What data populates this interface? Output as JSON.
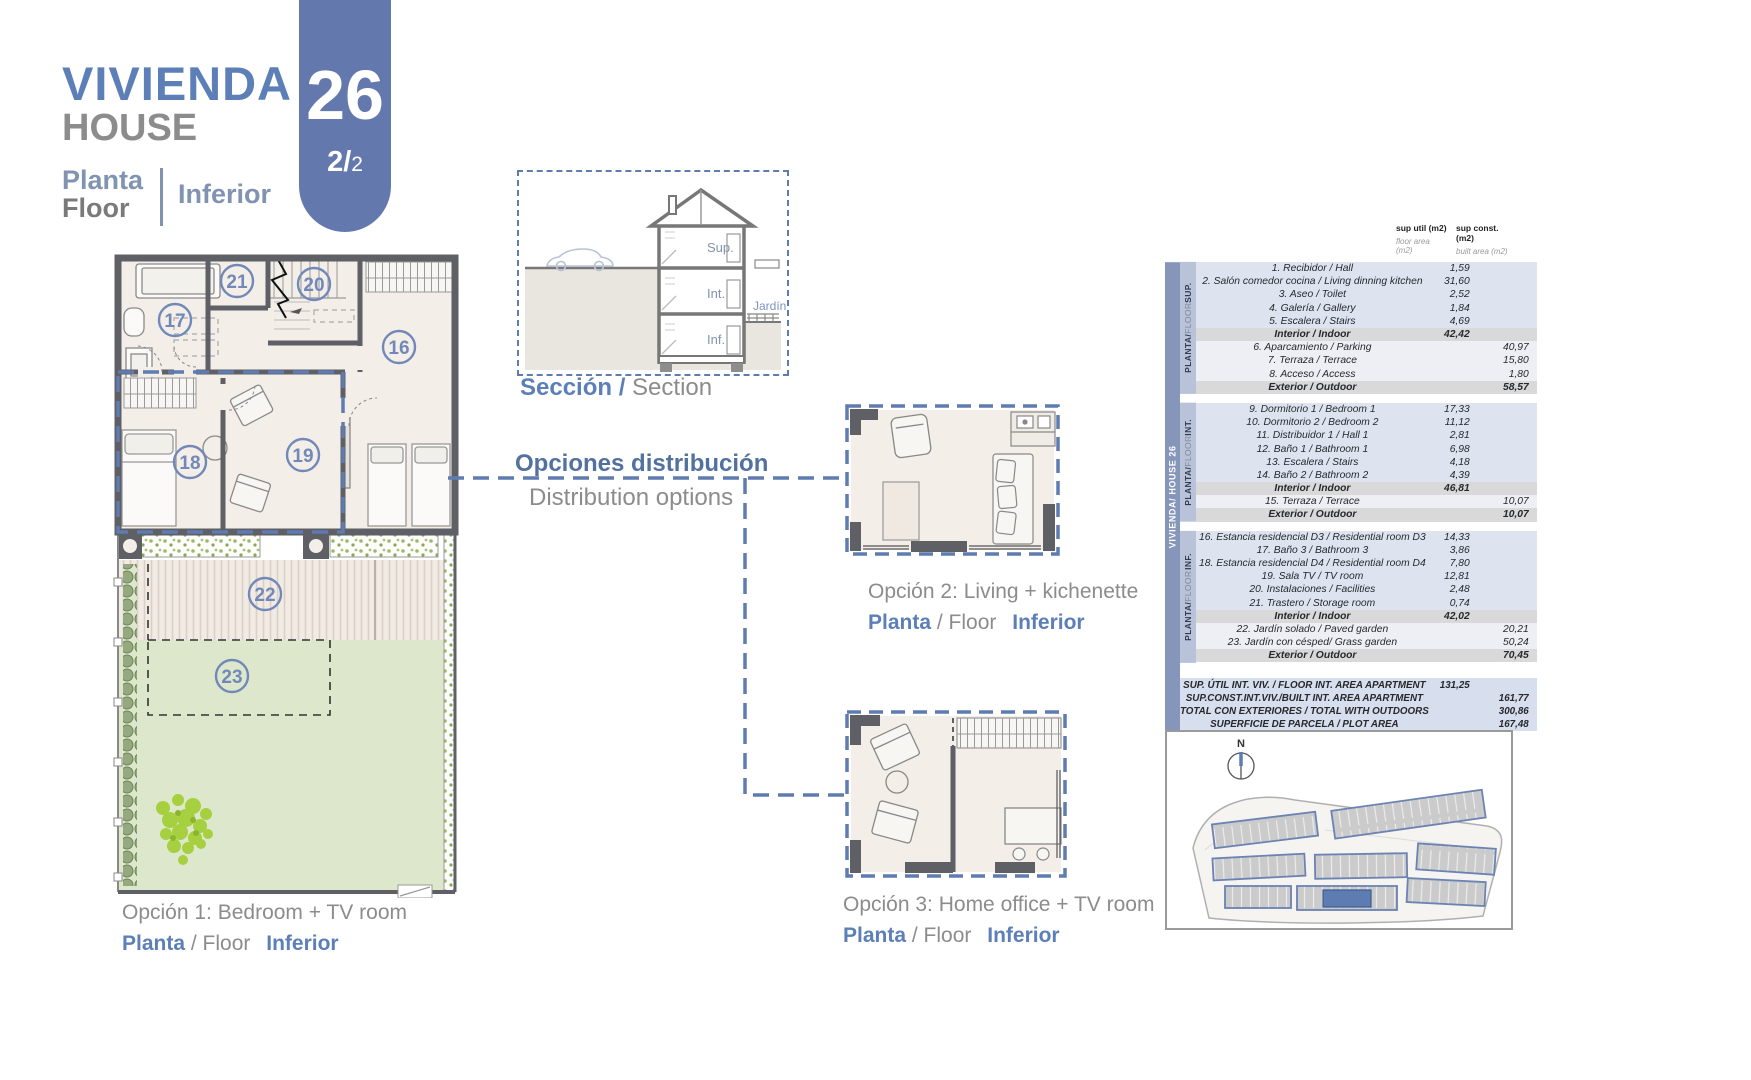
{
  "header": {
    "title_primary": "VIVIENDA",
    "title_secondary": "HOUSE",
    "unit_number": "26",
    "sheet_main": "2/",
    "sheet_sub": "2",
    "floor_word_es": "Planta",
    "floor_word_en": "Floor",
    "floor_name": "Inferior"
  },
  "section_view": {
    "floor_labels": {
      "sup": "Sup.",
      "int": "Int.",
      "inf": "Inf."
    },
    "garden_label": "Jardín",
    "caption_es": "Sección /",
    "caption_en": "Section"
  },
  "options_heading": {
    "es": "Opciones distribución",
    "en": "Distribution options"
  },
  "floor_plan": {
    "rooms": {
      "r16": "16",
      "r17": "17",
      "r18": "18",
      "r19": "19",
      "r20": "20",
      "r21": "21",
      "r22": "22",
      "r23": "23"
    }
  },
  "captions": {
    "option1": "Opción 1: Bedroom + TV room",
    "option2": "Opción 2: Living + kichenette",
    "option3": "Opción 3: Home office + TV room",
    "floor_es": "Planta",
    "floor_mid": "/ Floor",
    "floor_name": "Inferior"
  },
  "area_table": {
    "headers": {
      "col_util_bold": "sup util (m2)",
      "col_util_light": "floor area (m2)",
      "col_const_bold": "sup const. (m2)",
      "col_const_light": "built area (m2)"
    },
    "house_band": "VIVIENDA/ HOUSE 26",
    "sections": [
      {
        "band": [
          "PLANTA/",
          "FLOOR",
          "SUP."
        ],
        "rows": [
          {
            "label": "1. Recibidor / Hall",
            "u": "1,59",
            "c": "",
            "k": "r"
          },
          {
            "label": "2. Salón comedor cocina / Living dinning kitchen",
            "u": "31,60",
            "c": "",
            "k": "r"
          },
          {
            "label": "3. Aseo / Toilet",
            "u": "2,52",
            "c": "",
            "k": "r"
          },
          {
            "label": "4. Galería / Gallery",
            "u": "1,84",
            "c": "",
            "k": "r"
          },
          {
            "label": "5. Escalera / Stairs",
            "u": "4,69",
            "c": "",
            "k": "r"
          },
          {
            "label": "Interior / Indoor",
            "u": "42,42",
            "c": "",
            "k": "t"
          },
          {
            "label": "6. Aparcamiento / Parking",
            "u": "",
            "c": "40,97",
            "k": "e"
          },
          {
            "label": "7. Terraza / Terrace",
            "u": "",
            "c": "15,80",
            "k": "e"
          },
          {
            "label": "8. Acceso / Access",
            "u": "",
            "c": "1,80",
            "k": "e"
          },
          {
            "label": "Exterior / Outdoor",
            "u": "",
            "c": "58,57",
            "k": "t"
          }
        ]
      },
      {
        "band": [
          "PLANTA/",
          "FLOOR",
          "INT."
        ],
        "rows": [
          {
            "label": "9. Dormitorio 1 / Bedroom 1",
            "u": "17,33",
            "c": "",
            "k": "r"
          },
          {
            "label": "10. Dormitorio 2 / Bedroom 2",
            "u": "11,12",
            "c": "",
            "k": "r"
          },
          {
            "label": "11. Distribuidor 1 / Hall 1",
            "u": "2,81",
            "c": "",
            "k": "r"
          },
          {
            "label": "12. Baño 1 / Bathroom 1",
            "u": "6,98",
            "c": "",
            "k": "r"
          },
          {
            "label": "13. Escalera / Stairs",
            "u": "4,18",
            "c": "",
            "k": "r"
          },
          {
            "label": "14. Baño 2 / Bathroom 2",
            "u": "4,39",
            "c": "",
            "k": "r"
          },
          {
            "label": "Interior / Indoor",
            "u": "46,81",
            "c": "",
            "k": "t"
          },
          {
            "label": "15. Terraza / Terrace",
            "u": "",
            "c": "10,07",
            "k": "e"
          },
          {
            "label": "Exterior / Outdoor",
            "u": "",
            "c": "10,07",
            "k": "t"
          }
        ]
      },
      {
        "band": [
          "PLANTA/",
          "FLOOR",
          "INF."
        ],
        "rows": [
          {
            "label": "16. Estancia residencial D3 / Residential room D3",
            "u": "14,33",
            "c": "",
            "k": "r"
          },
          {
            "label": "17. Baño 3 / Bathroom 3",
            "u": "3,86",
            "c": "",
            "k": "r"
          },
          {
            "label": "18. Estancia residencial D4 / Residential room D4",
            "u": "7,80",
            "c": "",
            "k": "r"
          },
          {
            "label": "19. Sala TV / TV room",
            "u": "12,81",
            "c": "",
            "k": "r"
          },
          {
            "label": "20. Instalaciones / Facilities",
            "u": "2,48",
            "c": "",
            "k": "r"
          },
          {
            "label": "21. Trastero / Storage room",
            "u": "0,74",
            "c": "",
            "k": "r"
          },
          {
            "label": "Interior / Indoor",
            "u": "42,02",
            "c": "",
            "k": "t"
          },
          {
            "label": "22. Jardín solado / Paved garden",
            "u": "",
            "c": "20,21",
            "k": "e"
          },
          {
            "label": "23. Jardín con césped/ Grass garden",
            "u": "",
            "c": "50,24",
            "k": "e"
          },
          {
            "label": "Exterior / Outdoor",
            "u": "",
            "c": "70,45",
            "k": "t"
          }
        ]
      }
    ],
    "summary": [
      {
        "label": "SUP. ÚTIL INT. VIV. / FLOOR INT. AREA APARTMENT",
        "u": "131,25",
        "c": ""
      },
      {
        "label": "SUP.CONST.INT.VIV./BUILT INT. AREA APARTMENT",
        "u": "",
        "c": "161,77"
      },
      {
        "label": "TOTAL CON EXTERIORES / TOTAL WITH OUTDOORS",
        "u": "",
        "c": "300,86"
      },
      {
        "label": "SUPERFICIE DE PARCELA / PLOT AREA",
        "u": "",
        "c": "167,48"
      }
    ]
  },
  "site_plan": {
    "north_label": "N"
  }
}
